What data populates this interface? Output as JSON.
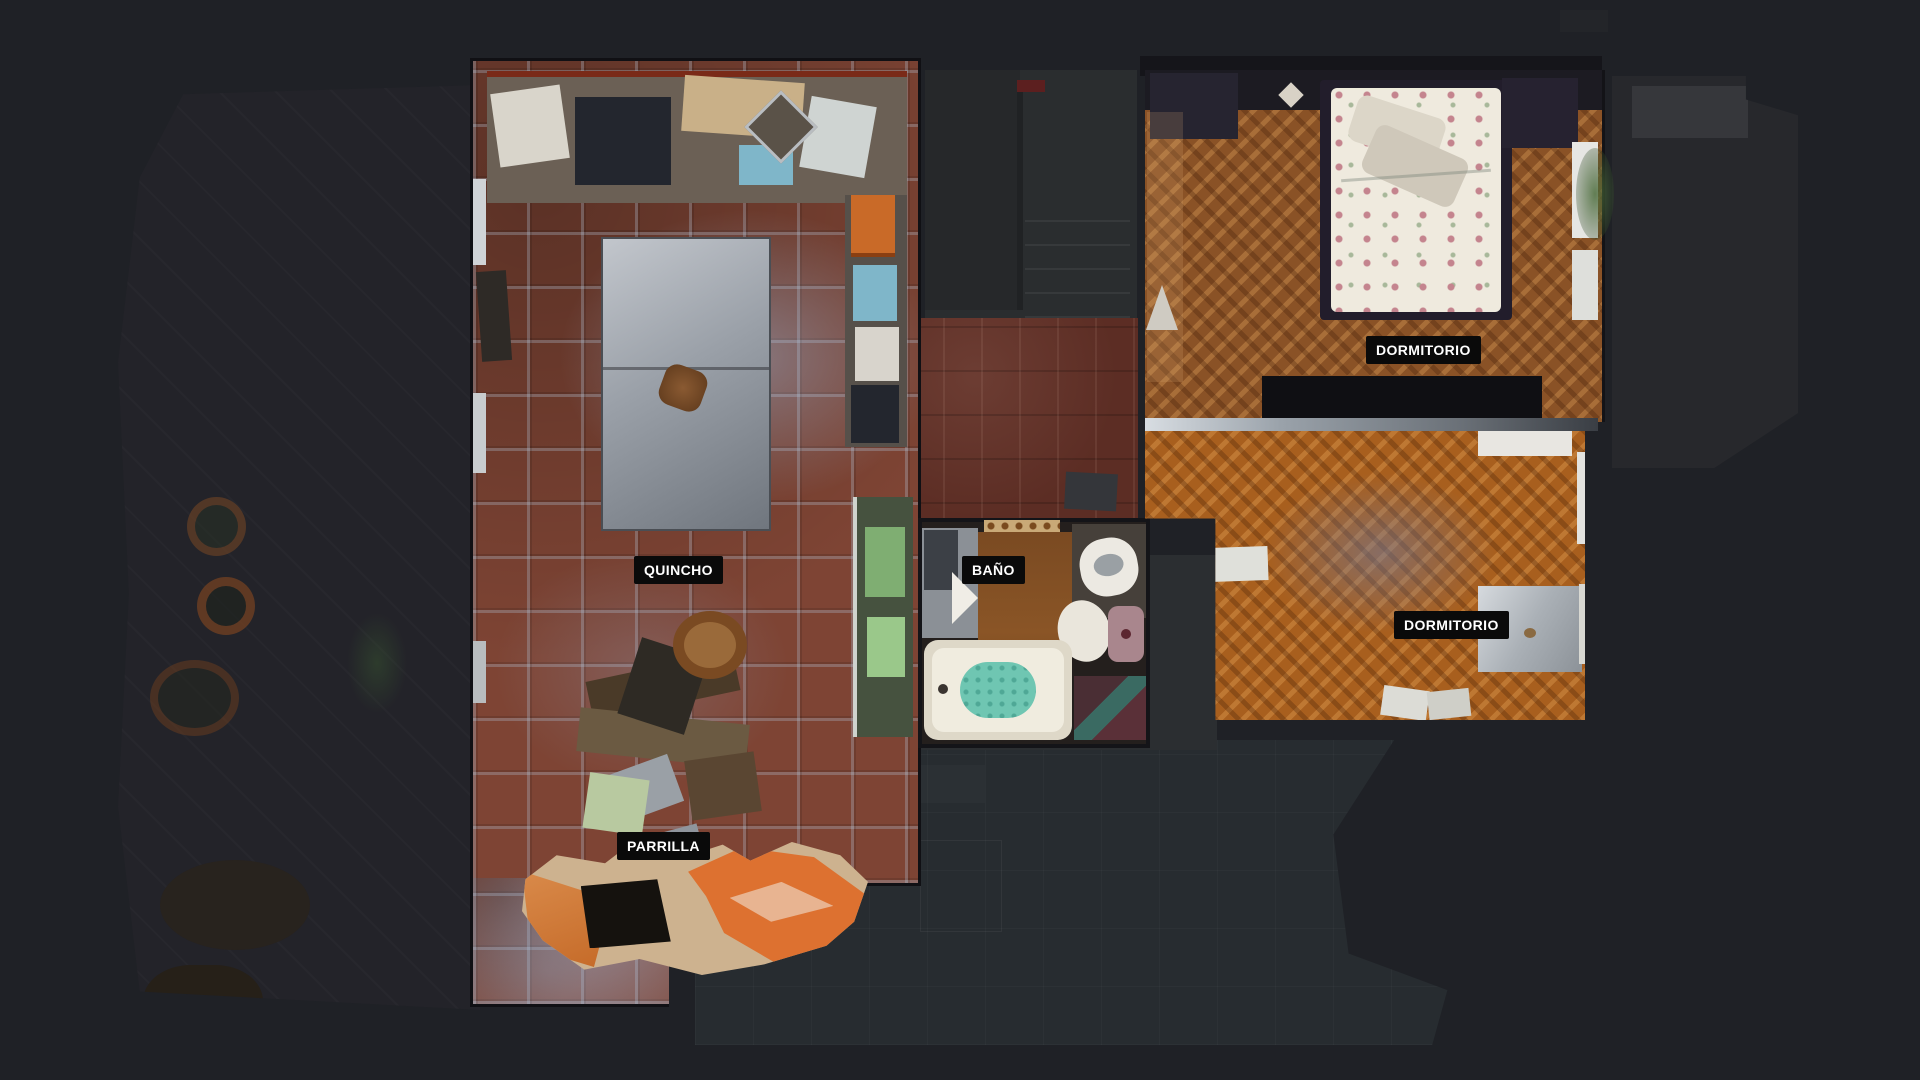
{
  "view": {
    "background_color": "#1f2126",
    "label_bg_color": "#0a0a0a",
    "label_text_color": "#ffffff",
    "floor_colors": {
      "terracotta_tile": "#7e4434",
      "parquet_dark": "#8a5226",
      "parquet_light": "#a85f1e",
      "marble_hall": "#5c2d24",
      "terrace_slate": "#272c30"
    }
  },
  "rooms": [
    {
      "id": "quincho",
      "label": "QUINCHO"
    },
    {
      "id": "bano",
      "label": "BAÑO"
    },
    {
      "id": "dormitorio_1",
      "label": "DORMITORIO"
    },
    {
      "id": "dormitorio_2",
      "label": "DORMITORIO"
    },
    {
      "id": "parrilla",
      "label": "PARRILLA"
    }
  ]
}
